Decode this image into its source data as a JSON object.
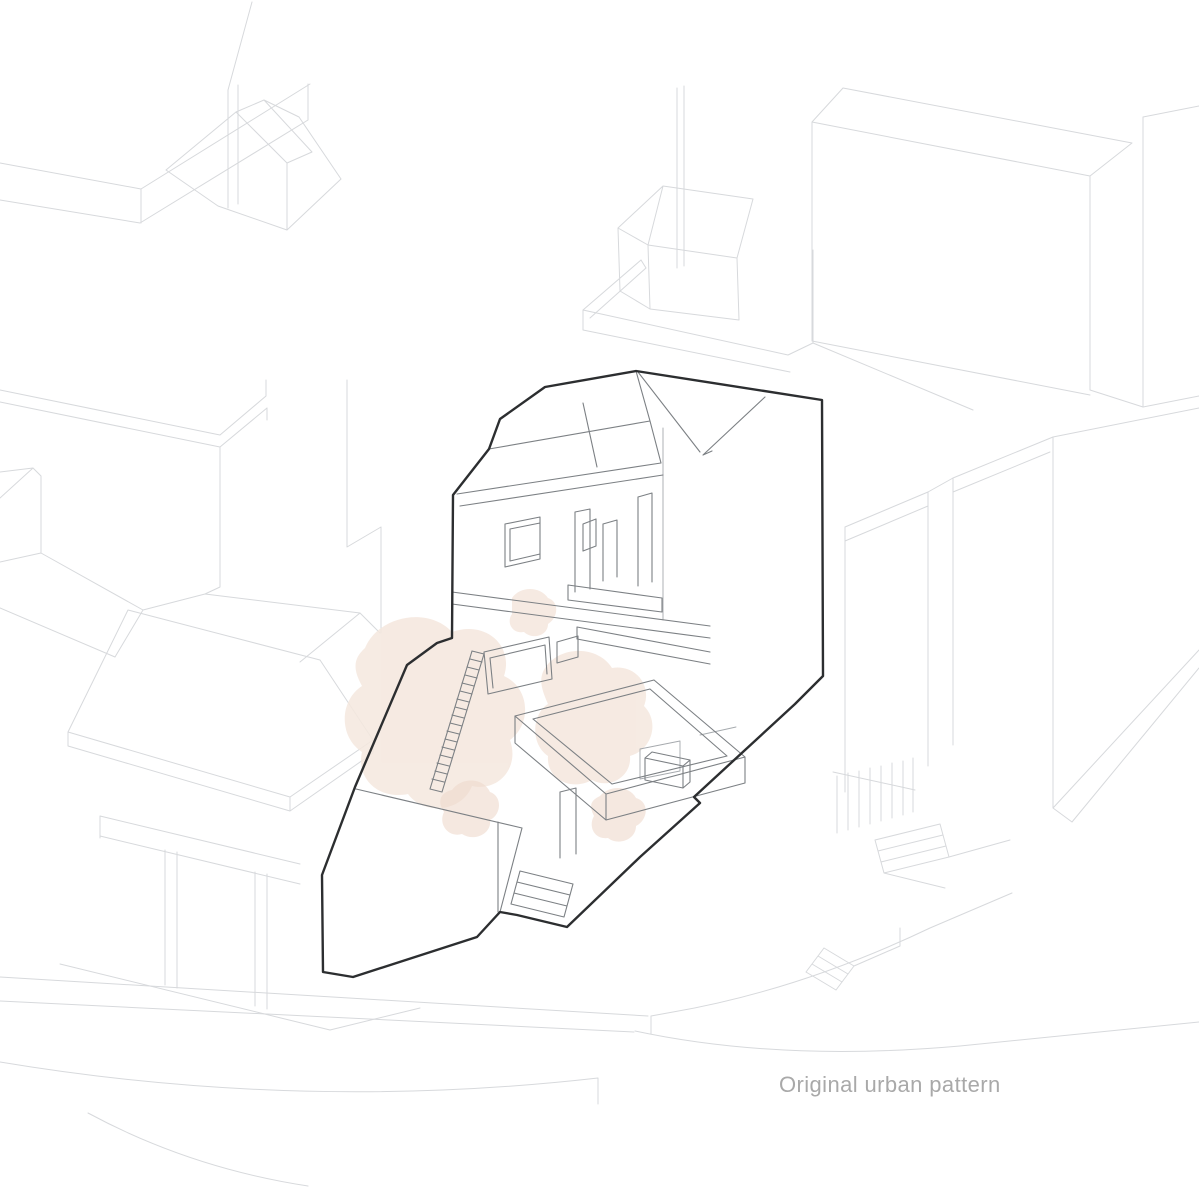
{
  "figure": {
    "type": "axonometric-line-drawing",
    "subject": "terraced building within surrounding urban fabric"
  },
  "caption": {
    "text": "Original urban pattern"
  },
  "palette": {
    "background": "#ffffff",
    "context_line": "#d7d9dc",
    "detail_line": "#7c8084",
    "fine_line": "#a6aaae",
    "outline": "#2c2e30",
    "foliage": "#f5e7de",
    "foliage_deep": "#efd8cb",
    "caption_text": "#a9a9a9"
  }
}
